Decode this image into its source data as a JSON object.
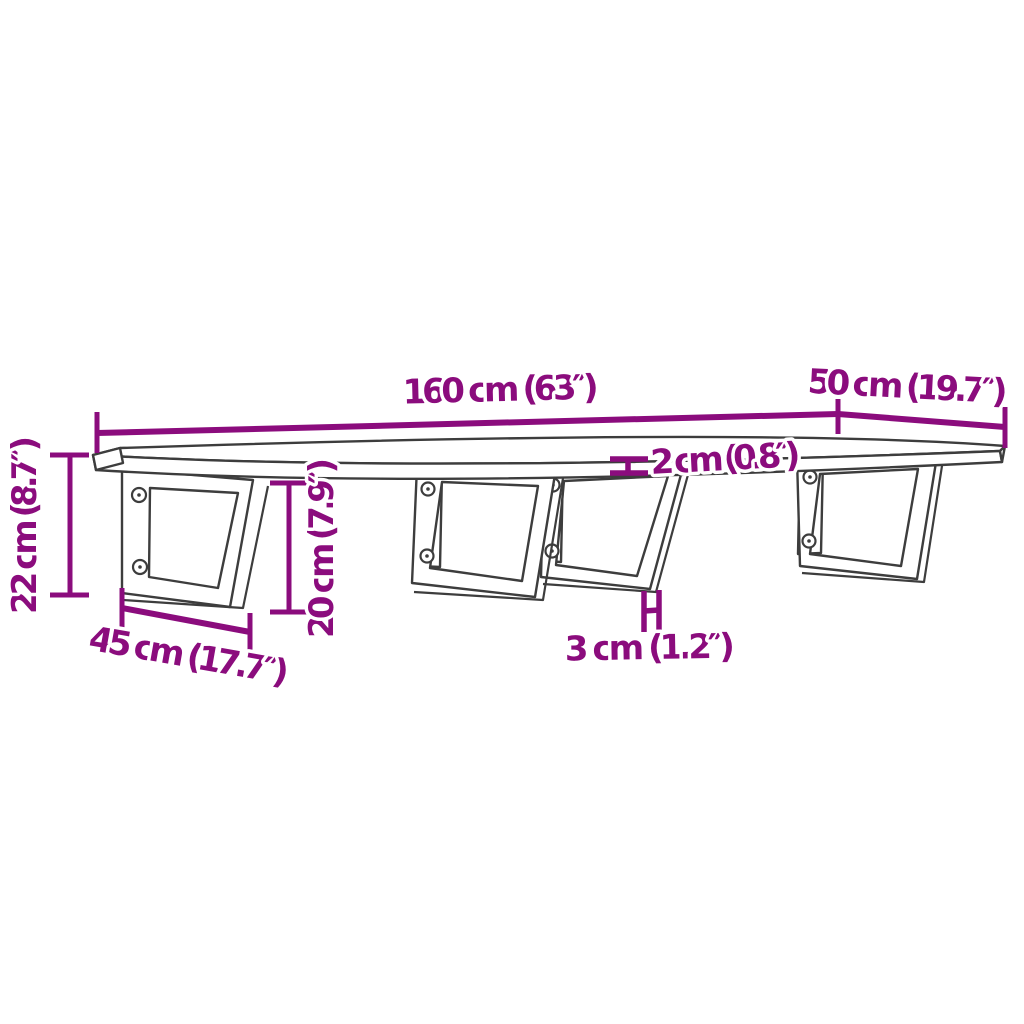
{
  "figure": {
    "type": "product-dimension-diagram",
    "subject": "wall-mounted shelf with four steel wall brackets",
    "background_color": "#ffffff",
    "line_color": "#3d3d3d",
    "accent_color": "#8b0c7d",
    "dimensions": {
      "length": "160 cm (63″)",
      "depth": "50 cm (19.7″)",
      "thickness": "2 cm (0.8″)",
      "height": "22 cm (8.7″)",
      "bracket_height": "20 cm (7.9″)",
      "bracket_depth": "45 cm (17.7″)",
      "bracket_thickness": "3 cm (1.2″)"
    }
  }
}
